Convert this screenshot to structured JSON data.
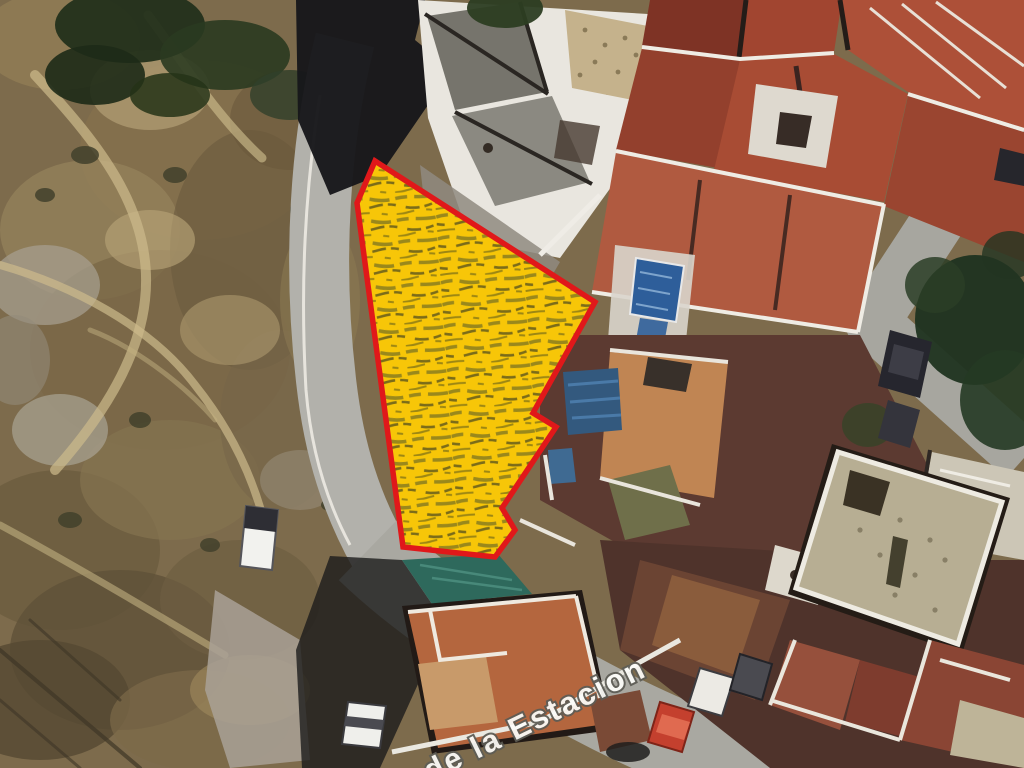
{
  "map": {
    "kind": "satellite-aerial-photo",
    "street_label": "de la Estacion",
    "parcel": {
      "outline_color": "#E0181A",
      "fill_color": "#F7C608",
      "points": "375,161 595,302 533,413 556,427 502,508 515,530 495,557 403,547 357,203"
    }
  }
}
